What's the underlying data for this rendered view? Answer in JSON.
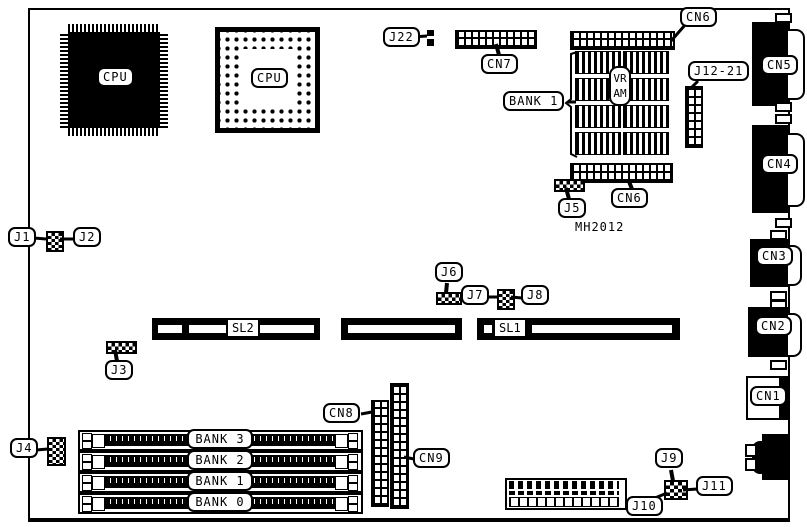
{
  "board": {
    "chips": {
      "cpu_qfp": "CPU",
      "cpu_pga": "CPU",
      "vram": "VRAM",
      "part_number": "MH2012"
    },
    "memory": {
      "bank1_vram": "BANK 1",
      "bank3": "BANK 3",
      "bank2": "BANK 2",
      "bank1": "BANK 1",
      "bank0": "BANK 0"
    },
    "slots": {
      "sl1": "SL1",
      "sl2": "SL2"
    },
    "connectors": {
      "cn1": "CN1",
      "cn2": "CN2",
      "cn3": "CN3",
      "cn4": "CN4",
      "cn5": "CN5",
      "cn6": "CN6",
      "cn7": "CN7",
      "cn8": "CN8",
      "cn9": "CN9"
    },
    "jumpers": {
      "j1": "J1",
      "j2": "J2",
      "j3": "J3",
      "j4": "J4",
      "j5": "J5",
      "j6": "J6",
      "j7": "J7",
      "j8": "J8",
      "j9": "J9",
      "j10": "J10",
      "j11": "J11",
      "j22": "J22",
      "j12_21": "J12-21"
    },
    "colors": {
      "ink": "#000000",
      "paper": "#ffffff"
    }
  }
}
